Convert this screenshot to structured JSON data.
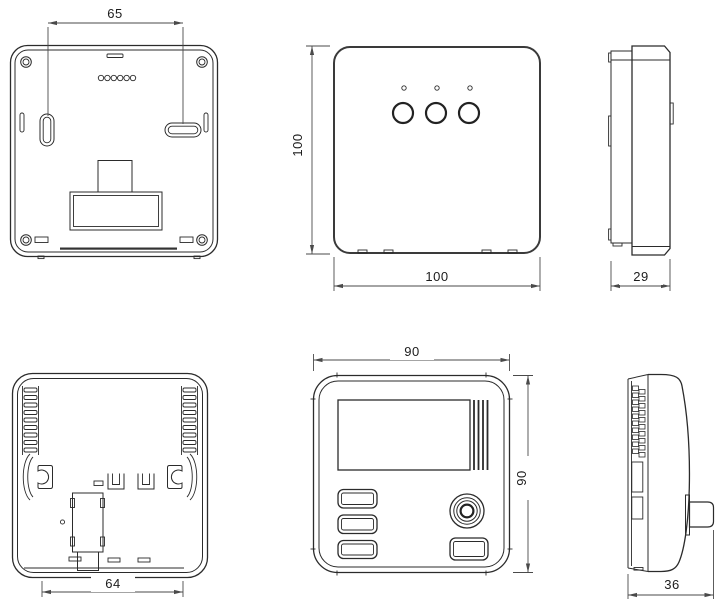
{
  "page": {
    "background": "#ffffff",
    "line_color": "#2b2b2b",
    "dimension_line_color": "#4a4a4a"
  },
  "dimensions": {
    "receiver_mount_spacing": "65",
    "receiver_height": "100",
    "receiver_width": "100",
    "receiver_depth": "29",
    "thermostat_width": "90",
    "thermostat_height": "90",
    "thermostat_mount_spacing": "64",
    "thermostat_depth": "36"
  }
}
